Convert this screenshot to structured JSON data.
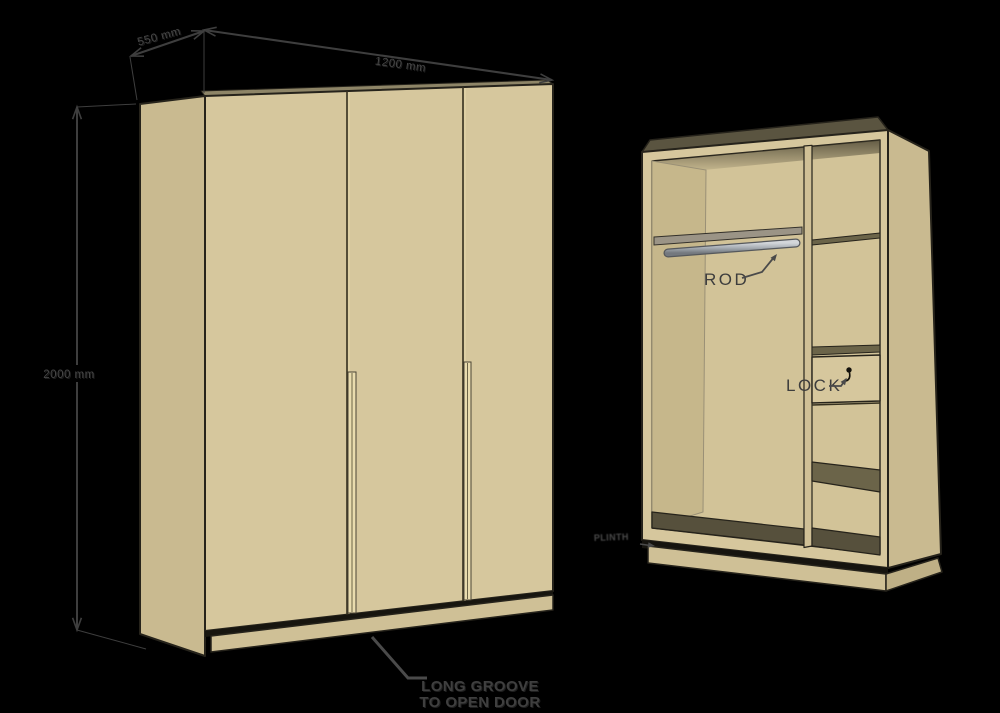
{
  "diagram": {
    "type": "wardrobe construction drawing",
    "annotations": {
      "width_dimension": "1200 mm",
      "depth_dimension": "550 mm",
      "height_dimension": "2000 mm",
      "rod_label": "ROD",
      "lock_label": "LOCK",
      "plinth_label": "PLINTH",
      "groove_label_line1": "LONG GROOVE",
      "groove_label_line2": "TO OPEN DOOR"
    },
    "colors": {
      "background": "#000000",
      "wood_front": "#d6c79d",
      "wood_side": "#c9ba90",
      "wood_interior_back": "#d2c398",
      "wood_top_face": "#5a5440",
      "shelf_top": "#6b6449",
      "compartment_floor": "#56503c",
      "outline": "#26231b",
      "rod_metal": "#b4b8be",
      "annotation_ink": "#3d3d3d"
    }
  }
}
